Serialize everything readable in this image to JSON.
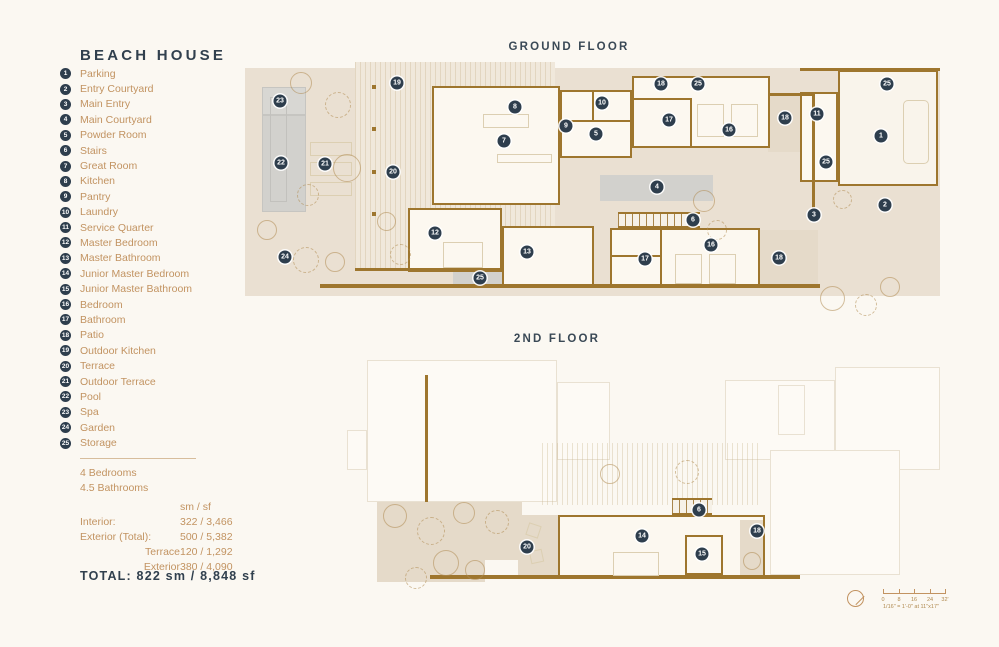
{
  "title": "BEACH HOUSE",
  "floors": {
    "ground": "GROUND FLOOR",
    "second": "2ND FLOOR"
  },
  "legend": [
    {
      "num": "1",
      "label": "Parking"
    },
    {
      "num": "2",
      "label": "Entry Courtyard"
    },
    {
      "num": "3",
      "label": "Main Entry"
    },
    {
      "num": "4",
      "label": "Main Courtyard"
    },
    {
      "num": "5",
      "label": "Powder Room"
    },
    {
      "num": "6",
      "label": "Stairs"
    },
    {
      "num": "7",
      "label": "Great Room"
    },
    {
      "num": "8",
      "label": "Kitchen"
    },
    {
      "num": "9",
      "label": "Pantry"
    },
    {
      "num": "10",
      "label": "Laundry"
    },
    {
      "num": "11",
      "label": "Service Quarter"
    },
    {
      "num": "12",
      "label": "Master Bedroom"
    },
    {
      "num": "13",
      "label": "Master Bathroom"
    },
    {
      "num": "14",
      "label": "Junior Master Bedroom"
    },
    {
      "num": "15",
      "label": "Junior Master Bathroom"
    },
    {
      "num": "16",
      "label": "Bedroom"
    },
    {
      "num": "17",
      "label": "Bathroom"
    },
    {
      "num": "18",
      "label": "Patio"
    },
    {
      "num": "19",
      "label": "Outdoor Kitchen"
    },
    {
      "num": "20",
      "label": "Terrace"
    },
    {
      "num": "21",
      "label": "Outdoor Terrace"
    },
    {
      "num": "22",
      "label": "Pool"
    },
    {
      "num": "23",
      "label": "Spa"
    },
    {
      "num": "24",
      "label": "Garden"
    },
    {
      "num": "25",
      "label": "Storage"
    }
  ],
  "stats": {
    "bedrooms": "4 Bedrooms",
    "bathrooms": "4.5 Bathrooms",
    "unit_header": "sm / sf",
    "rows": [
      {
        "label": "Interior:",
        "value": "322 / 3,466",
        "indent": false
      },
      {
        "label": "Exterior (Total):",
        "value": "500 / 5,382",
        "indent": false
      },
      {
        "label": "Terrace",
        "value": "120 / 1,292",
        "indent": true
      },
      {
        "label": "Exterior",
        "value": "380 / 4,090",
        "indent": true
      }
    ],
    "total": "TOTAL: 822 sm / 8,848 sf"
  },
  "scale": {
    "ticks": [
      "0",
      "8",
      "16",
      "24",
      "32'"
    ],
    "note": "1/16\" = 1'-0\" at 11\"x17\""
  },
  "markers": {
    "ground": [
      {
        "n": "1",
        "x": 636,
        "y": 74
      },
      {
        "n": "2",
        "x": 640,
        "y": 143
      },
      {
        "n": "3",
        "x": 569,
        "y": 153
      },
      {
        "n": "4",
        "x": 412,
        "y": 125
      },
      {
        "n": "5",
        "x": 351,
        "y": 72
      },
      {
        "n": "6",
        "x": 448,
        "y": 158
      },
      {
        "n": "7",
        "x": 259,
        "y": 79
      },
      {
        "n": "8",
        "x": 270,
        "y": 45
      },
      {
        "n": "9",
        "x": 321,
        "y": 64
      },
      {
        "n": "10",
        "x": 357,
        "y": 41
      },
      {
        "n": "11",
        "x": 572,
        "y": 52
      },
      {
        "n": "12",
        "x": 190,
        "y": 171
      },
      {
        "n": "13",
        "x": 282,
        "y": 190
      },
      {
        "n": "16",
        "x": 484,
        "y": 68
      },
      {
        "n": "16",
        "x": 466,
        "y": 183
      },
      {
        "n": "17",
        "x": 424,
        "y": 58
      },
      {
        "n": "17",
        "x": 400,
        "y": 197
      },
      {
        "n": "18",
        "x": 416,
        "y": 22
      },
      {
        "n": "18",
        "x": 540,
        "y": 56
      },
      {
        "n": "18",
        "x": 534,
        "y": 196
      },
      {
        "n": "19",
        "x": 152,
        "y": 21
      },
      {
        "n": "20",
        "x": 148,
        "y": 110
      },
      {
        "n": "21",
        "x": 80,
        "y": 102
      },
      {
        "n": "22",
        "x": 36,
        "y": 101
      },
      {
        "n": "23",
        "x": 35,
        "y": 39
      },
      {
        "n": "24",
        "x": 40,
        "y": 195
      },
      {
        "n": "25",
        "x": 453,
        "y": 22
      },
      {
        "n": "25",
        "x": 581,
        "y": 100
      },
      {
        "n": "25",
        "x": 642,
        "y": 22
      },
      {
        "n": "25",
        "x": 235,
        "y": 216
      }
    ],
    "second": [
      {
        "n": "6",
        "x": 354,
        "y": 158
      },
      {
        "n": "14",
        "x": 297,
        "y": 184
      },
      {
        "n": "15",
        "x": 357,
        "y": 202
      },
      {
        "n": "18",
        "x": 412,
        "y": 179
      },
      {
        "n": "20",
        "x": 182,
        "y": 195
      }
    ]
  },
  "colors": {
    "navy": "#2E3E4D",
    "tan_text": "#C29361",
    "wall_brown": "#9E762E",
    "plan_beige": "#EAE0D2",
    "room_white": "#FCF8F0",
    "pool_gray": "#D2D1CD",
    "page_bg": "#FBF8F2"
  }
}
